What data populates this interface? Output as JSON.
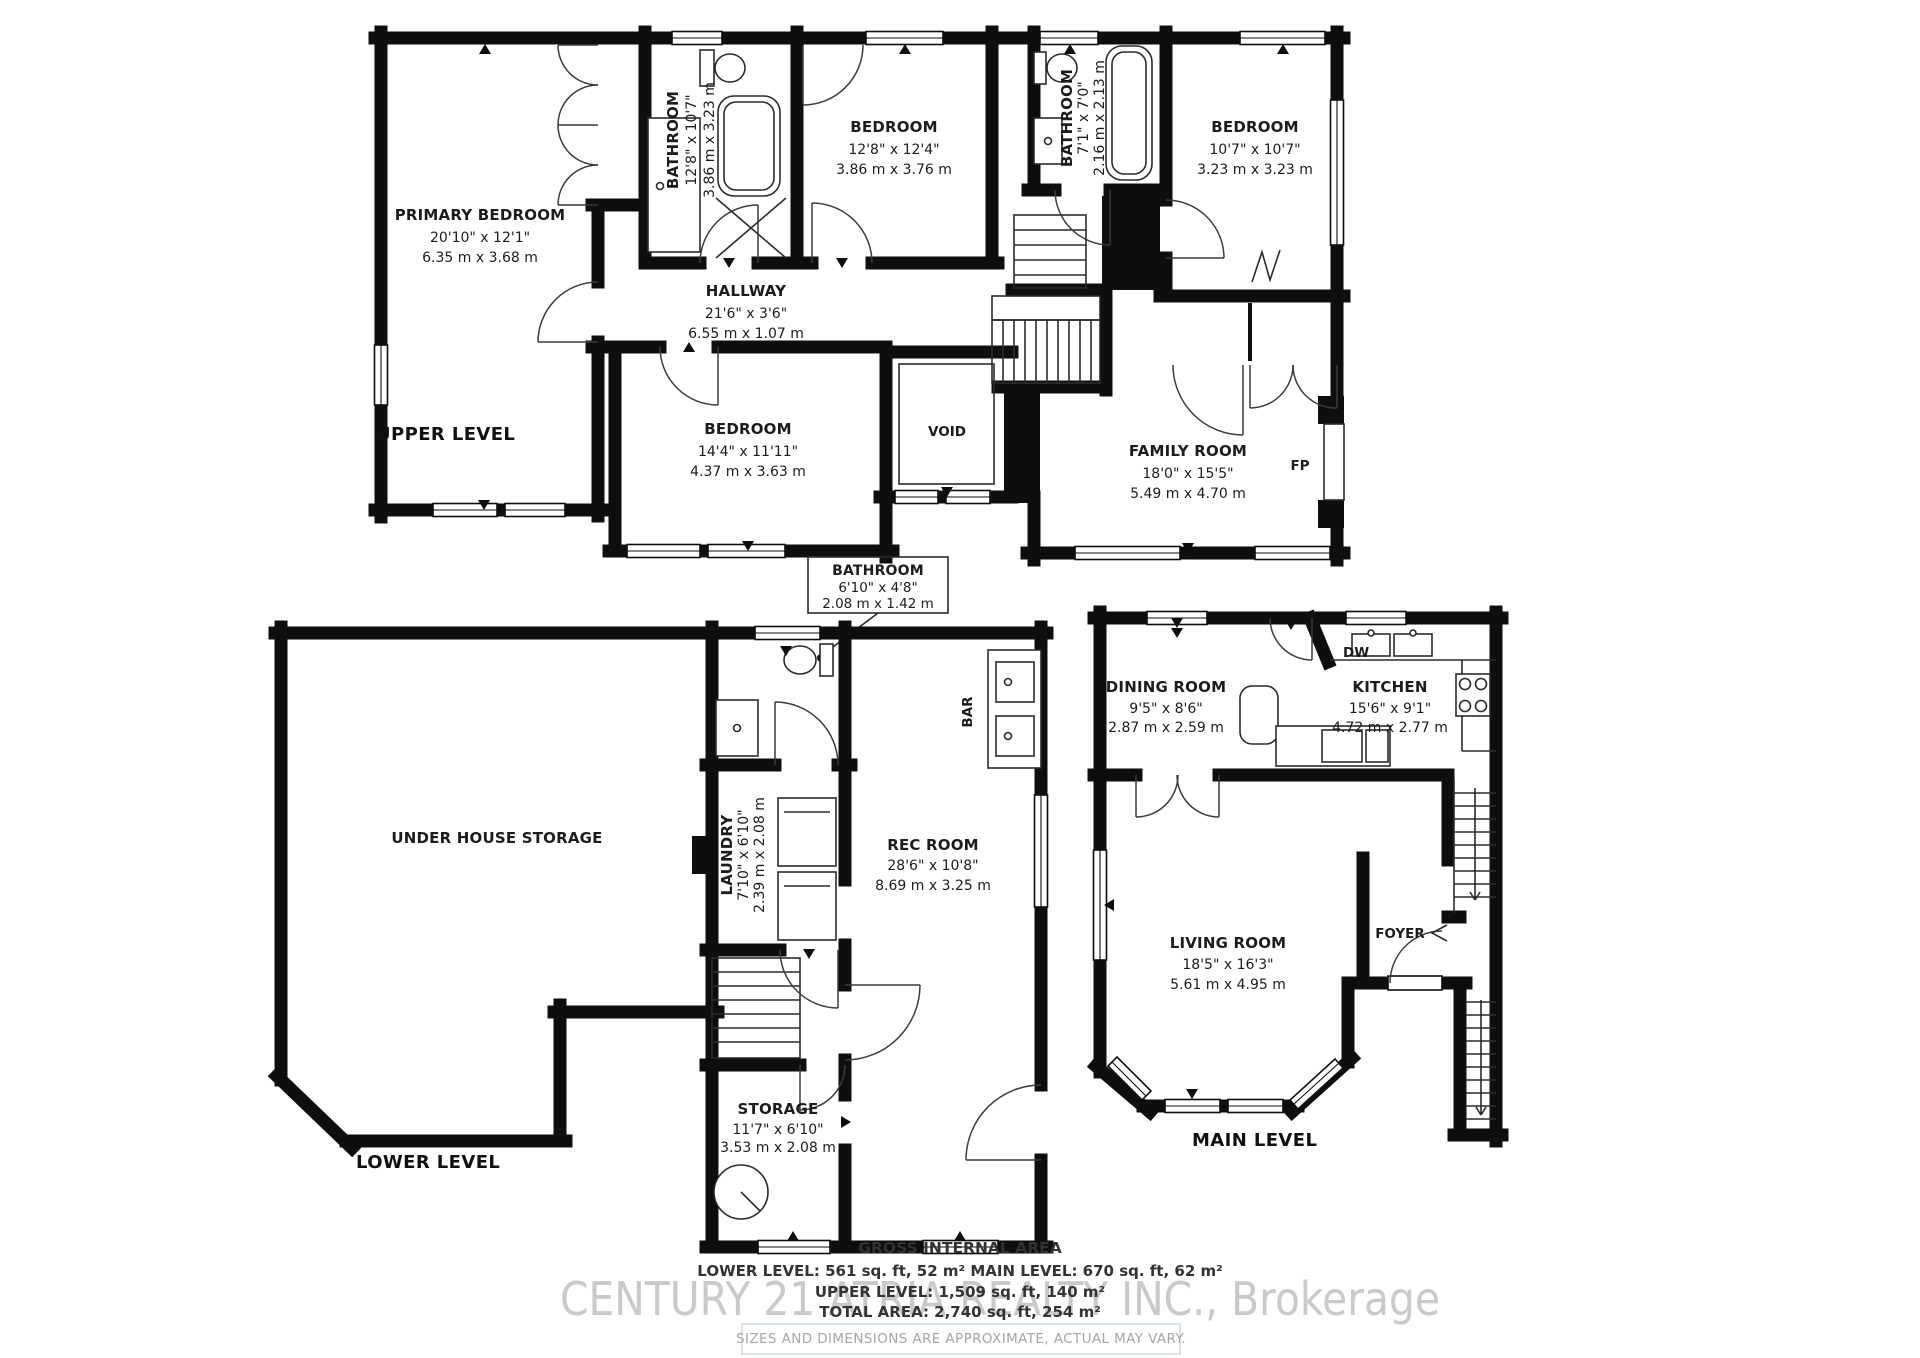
{
  "levels": {
    "upper": {
      "label": "UPPER LEVEL",
      "rooms": {
        "primary": {
          "name": "PRIMARY BEDROOM",
          "imperial": "20'10\" x 12'1\"",
          "metric": "6.35 m x 3.68 m"
        },
        "bathroom1": {
          "name": "BATHROOM",
          "imperial": "12'8\" x 10'7\"",
          "metric": "3.86 m x 3.23 m"
        },
        "bedroom2": {
          "name": "BEDROOM",
          "imperial": "12'8\" x 12'4\"",
          "metric": "3.86 m x 3.76 m"
        },
        "bathroom2": {
          "name": "BATHROOM",
          "imperial": "7'1\" x 7'0\"",
          "metric": "2.16 m x 2.13 m"
        },
        "bedroom4": {
          "name": "BEDROOM",
          "imperial": "10'7\" x 10'7\"",
          "metric": "3.23 m x 3.23 m"
        },
        "hallway": {
          "name": "HALLWAY",
          "imperial": "21'6\" x 3'6\"",
          "metric": "6.55 m x 1.07 m"
        },
        "void": {
          "name": "VOID"
        },
        "family": {
          "name": "FAMILY ROOM",
          "imperial": "18'0\" x 15'5\"",
          "metric": "5.49 m x 4.70 m"
        },
        "fp": {
          "name": "FP"
        },
        "bedroom3": {
          "name": "BEDROOM",
          "imperial": "14'4\" x 11'11\"",
          "metric": "4.37 m x 3.63 m"
        }
      }
    },
    "lower": {
      "label": "LOWER LEVEL",
      "rooms": {
        "under_storage": {
          "name": "UNDER HOUSE STORAGE"
        },
        "bathroom": {
          "name": "BATHROOM",
          "imperial": "6'10\" x 4'8\"",
          "metric": "2.08 m x 1.42 m"
        },
        "laundry": {
          "name": "LAUNDRY",
          "imperial": "7'10\" x 6'10\"",
          "metric": "2.39 m x 2.08 m"
        },
        "rec": {
          "name": "REC ROOM",
          "imperial": "28'6\" x 10'8\"",
          "metric": "8.69 m x 3.25 m"
        },
        "bar": {
          "name": "BAR"
        },
        "storage": {
          "name": "STORAGE",
          "imperial": "11'7\" x 6'10\"",
          "metric": "3.53 m x 2.08 m"
        }
      }
    },
    "main": {
      "label": "MAIN LEVEL",
      "rooms": {
        "dining": {
          "name": "DINING ROOM",
          "imperial": "9'5\" x 8'6\"",
          "metric": "2.87 m x 2.59 m"
        },
        "kitchen": {
          "name": "KITCHEN",
          "imperial": "15'6\" x 9'1\"",
          "metric": "4.72 m x 2.77 m"
        },
        "dw": {
          "name": "DW"
        },
        "living": {
          "name": "LIVING ROOM",
          "imperial": "18'5\" x 16'3\"",
          "metric": "5.61 m x 4.95 m"
        },
        "foyer": {
          "name": "FOYER"
        }
      }
    }
  },
  "footer": {
    "title": "GROSS INTERNAL AREA",
    "line1": "LOWER LEVEL: 561 sq. ft, 52 m² MAIN LEVEL: 670 sq. ft, 62 m²",
    "line2": "UPPER LEVEL: 1,509 sq. ft, 140 m²",
    "line3": "TOTAL AREA: 2,740 sq. ft, 254 m²",
    "watermark": "CENTURY 21 ATRIA REALTY INC., Brokerage",
    "disclaimer": "SIZES AND DIMENSIONS ARE APPROXIMATE, ACTUAL MAY VARY."
  },
  "colors": {
    "wall": "#0e0e0e",
    "watermark": "#c9c9c9",
    "disclaimer_border": "#cdddd3"
  }
}
